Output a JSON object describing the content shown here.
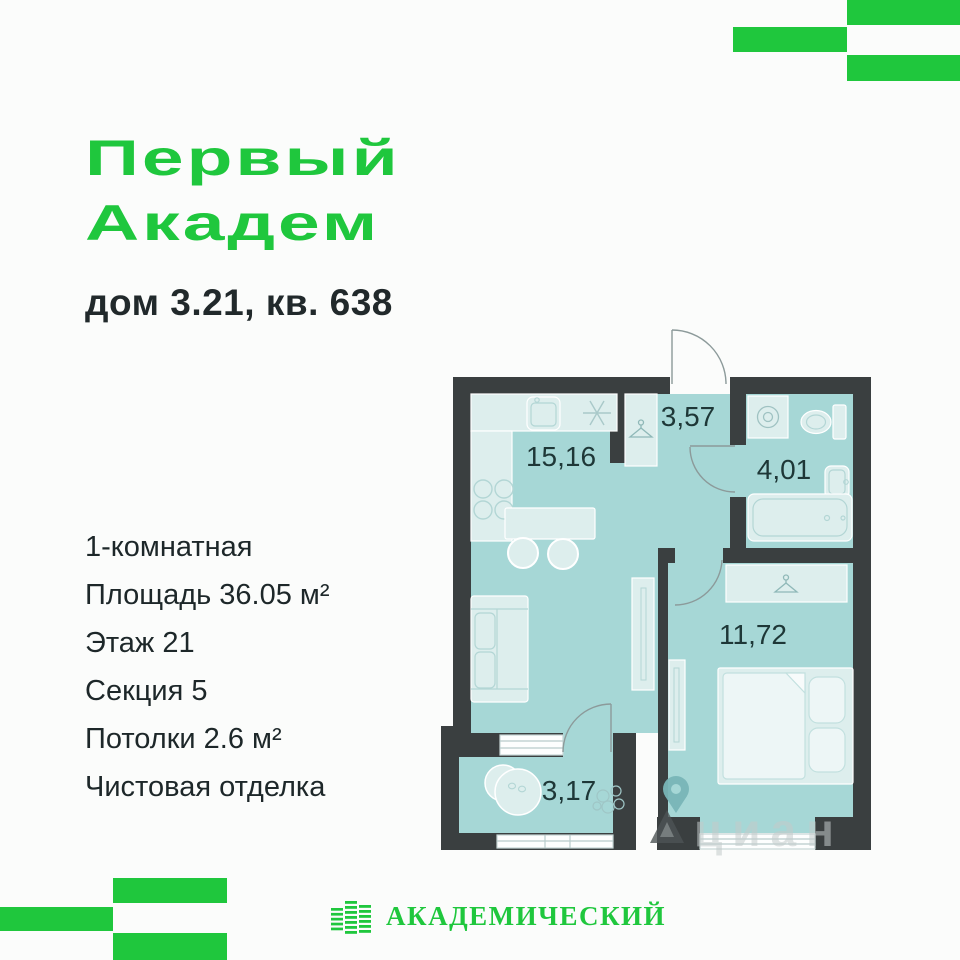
{
  "page": {
    "background": "#fbfcfb"
  },
  "brand": {
    "accent_green": "#1fc73d",
    "title_line1": "Первый",
    "title_line2": "Академ",
    "subtitle": "дом 3.21, кв. 638"
  },
  "info": {
    "items": [
      "1-комнатная",
      "Площадь 36.05 м²",
      "Этаж 21",
      "Секция 5",
      "Потолки 2.6 м²",
      "Чистовая отделка"
    ]
  },
  "floorplan": {
    "wall_color": "#3a3f40",
    "floor_color": "#a6d7d6",
    "furniture_color": "#ddeeed",
    "rooms": [
      {
        "name": "kitchen-living-room",
        "area": "15,16"
      },
      {
        "name": "hallway",
        "area": "3,57"
      },
      {
        "name": "bathroom",
        "area": "4,01"
      },
      {
        "name": "bedroom",
        "area": "11,72"
      },
      {
        "name": "balcony",
        "area": "3,17"
      }
    ]
  },
  "watermark": {
    "text": "циан"
  },
  "footer": {
    "logo_text": "АКАДЕМИЧЕСКИЙ"
  }
}
